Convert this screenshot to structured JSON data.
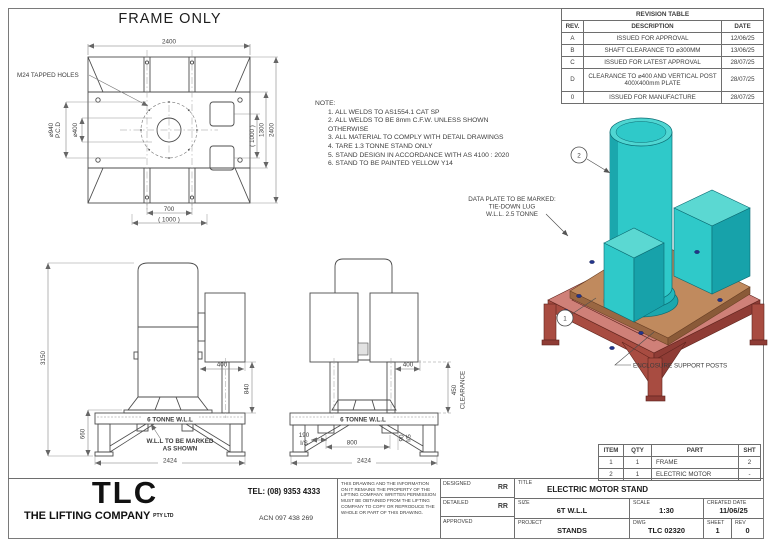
{
  "colors": {
    "frame_paint": "#cf8078",
    "frame_paint_dark": "#a84c41",
    "frame_paint_deep": "#8f3c35",
    "plate_tan": "#c08a5e",
    "plate_tan_dark": "#9a6742",
    "motor_teal": "#2fc9c9",
    "motor_teal_light": "#5bd8d2",
    "motor_teal_dark": "#17a2aa",
    "bolt_blue": "#23348c",
    "line_gray": "#4d4d4d"
  },
  "top_view": {
    "title": "FRAME ONLY",
    "label_m24": "M24 TAPPED HOLES",
    "dim_top": "2400",
    "dim_pcd": "⌀940",
    "dim_pcd_sub": "P.C.D",
    "dim_bore": "⌀400",
    "dim_right_inner": "( 1000 )",
    "dim_right_mid": "1300",
    "dim_right_outer": "2400",
    "dim_bottom_inner": "700",
    "dim_bottom_outer": "( 1000 )"
  },
  "notes": {
    "label": "NOTE:",
    "items": [
      "1.  ALL WELDS TO AS1554.1 CAT SP",
      "2.  ALL WELDS TO BE 8mm C.F.W. UNLESS SHOWN OTHERWISE",
      "3.  ALL MATERIAL TO COMPLY WITH DETAIL DRAWINGS",
      "4.  TARE 1.3 TONNE STAND ONLY",
      "5.  STAND DESIGN IN ACCORDANCE WITH AS 4100 : 2020",
      "6.  STAND TO BE PAINTED YELLOW Y14"
    ]
  },
  "revision_table": {
    "title": "REVISION TABLE",
    "headers": {
      "rev": "REV.",
      "description": "DESCRIPTION",
      "date": "DATE"
    },
    "rows": [
      {
        "rev": "A",
        "description": "ISSUED FOR APPROVAL",
        "date": "12/06/25"
      },
      {
        "rev": "B",
        "description": "SHAFT CLEARANCE TO ⌀300MM",
        "date": "13/06/25"
      },
      {
        "rev": "C",
        "description": "ISSUED FOR LATEST APPROVAL",
        "date": "28/07/25"
      },
      {
        "rev": "D",
        "description": "CLEARANCE TO ⌀400 AND VERTICAL POST 400X400mm PLATE",
        "date": "28/07/25"
      },
      {
        "rev": "0",
        "description": "ISSUED FOR MANUFACTURE",
        "date": "28/07/25"
      }
    ]
  },
  "iso_view": {
    "data_plate_line1": "DATA PLATE TO BE MARKED:",
    "data_plate_line2": "TIE-DOWN LUG",
    "data_plate_line3": "W.L.L. 2.5 TONNE",
    "balloon_1": "1",
    "balloon_2": "2",
    "label_posts": "ENCLOSURE SUPPORT POSTS"
  },
  "side_view": {
    "dim_height": "3150",
    "dim_stand": "660",
    "dim_gap": "400",
    "dim_post": "840",
    "dim_width": "2424",
    "label_wll": "6 TONNE W.L.L",
    "callout_line1": "W.L.L TO BE MARKED",
    "callout_line2": "AS SHOWN"
  },
  "front_view": {
    "dim_gap": "400",
    "dim_clear": "450",
    "label_clear": "CLEARANCE",
    "dim_190": "190",
    "label_is_left": "I/S",
    "dim_800": "800",
    "dim_90": "90",
    "label_is_right": "I/S",
    "dim_width": "2424",
    "label_wll": "6 TONNE W.L.L"
  },
  "item_table": {
    "headers": {
      "item": "ITEM",
      "qty": "QTY",
      "part": "PART",
      "sht": "SHT"
    },
    "rows": [
      {
        "item": "1",
        "qty": "1",
        "part": "FRAME",
        "sht": "2"
      },
      {
        "item": "2",
        "qty": "1",
        "part": "ELECTRIC MOTOR",
        "sht": "-"
      }
    ]
  },
  "title_block": {
    "logo": "TLC",
    "company": "THE LIFTING COMPANY",
    "company_suffix": "PTY LTD",
    "tel": "TEL: (08) 9353 4333",
    "acn": "ACN 097 438 269",
    "disclaimer": "THIS DRAWING AND THE INFORMATION ON IT REMAINS THE PROPERTY OF THE LIFTING COMPANY. WRITTEN PERMISSION MUST BE OBTAINED FROM THE LIFTING COMPANY TO COPY OR REPRODUCE THE WHOLE OR PART OF THIS DRAWING.",
    "designed_label": "DESIGNED",
    "designed_value": "RR",
    "detailed_label": "DETAILED",
    "detailed_value": "RR",
    "approved_label": "APPROVED",
    "approved_value": "",
    "title_label": "TITLE",
    "title_value": "ELECTRIC MOTOR STAND",
    "size_label": "SIZE",
    "size_value": "6T W.L.L",
    "scale_label": "SCALE",
    "scale_value": "1:30",
    "created_label": "CREATED DATE",
    "created_value": "11/06/25",
    "project_label": "PROJECT",
    "project_value": "STANDS",
    "dwg_label": "DWG",
    "dwg_value": "TLC 02320",
    "sheet_label": "SHEET",
    "sheet_value": "1",
    "rev_label": "REV",
    "rev_value": "0"
  }
}
